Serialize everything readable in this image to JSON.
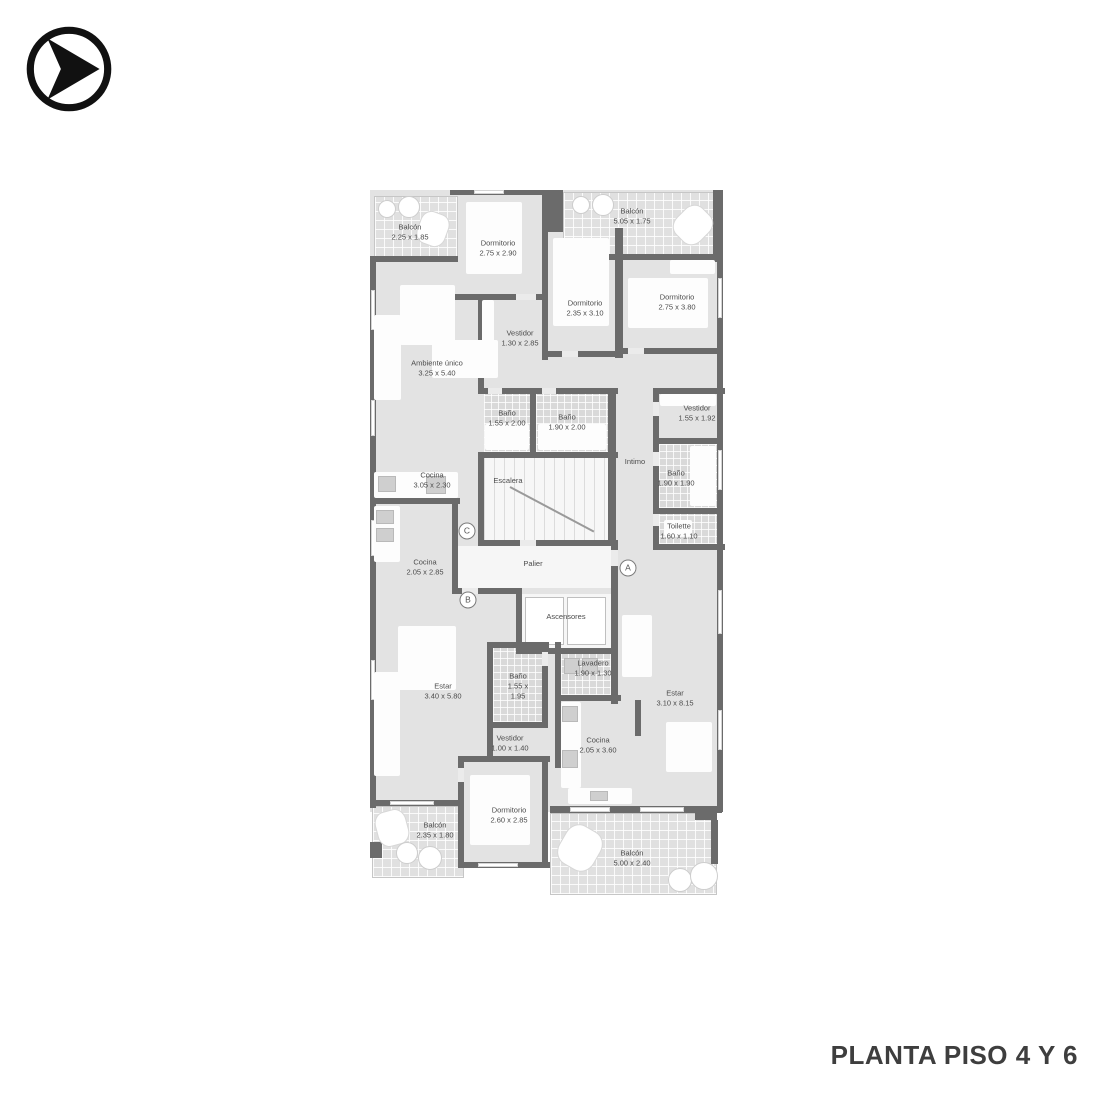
{
  "title": "PLANTA PISO 4 Y 6",
  "logo": {
    "icon": "arrow-in-circle"
  },
  "colors": {
    "wall": "#6b6b6b",
    "floor": "#e3e3e3",
    "caption_text": "#3e3e3e"
  },
  "plan": {
    "markers": [
      "A",
      "B",
      "C"
    ],
    "rooms": [
      {
        "name": "Balcón",
        "dims": "2.25 x 1.85"
      },
      {
        "name": "Dormitorio",
        "dims": "2.75 x 2.90"
      },
      {
        "name": "Balcón",
        "dims": "5.05 x 1.75"
      },
      {
        "name": "Dormitorio",
        "dims": "2.35 x 3.10"
      },
      {
        "name": "Dormitorio",
        "dims": "2.75 x 3.80"
      },
      {
        "name": "Ambiente único",
        "dims": "3.25 x 5.40"
      },
      {
        "name": "Vestidor",
        "dims": "1.30 x 2.85"
      },
      {
        "name": "Baño",
        "dims": "1.55 x 2.00"
      },
      {
        "name": "Baño",
        "dims": "1.90 x 2.00"
      },
      {
        "name": "Vestidor",
        "dims": "1.55 x 1.92"
      },
      {
        "name": "Intimo",
        "dims": ""
      },
      {
        "name": "Baño",
        "dims": "1.90 x 1.90"
      },
      {
        "name": "Toilette",
        "dims": "1.60 x 1.10"
      },
      {
        "name": "Cocina",
        "dims": "3.05 x 2.30"
      },
      {
        "name": "Escalera",
        "dims": ""
      },
      {
        "name": "Cocina",
        "dims": "2.05 x 2.85"
      },
      {
        "name": "Palier",
        "dims": ""
      },
      {
        "name": "Ascensores",
        "dims": ""
      },
      {
        "name": "Lavadero",
        "dims": "1.90 x 1.30"
      },
      {
        "name": "Estar",
        "dims": "3.40 x 5.80"
      },
      {
        "name": "Baño",
        "dims": "1.55 x 1.95"
      },
      {
        "name": "Estar",
        "dims": "3.10 x 8.15"
      },
      {
        "name": "Vestidor",
        "dims": "1.00 x 1.40"
      },
      {
        "name": "Cocina",
        "dims": "2.05 x 3.60"
      },
      {
        "name": "Dormitorio",
        "dims": "2.60 x 2.85"
      },
      {
        "name": "Balcón",
        "dims": "2.35 x 1.80"
      },
      {
        "name": "Balcón",
        "dims": "5.00 x 2.40"
      }
    ]
  }
}
